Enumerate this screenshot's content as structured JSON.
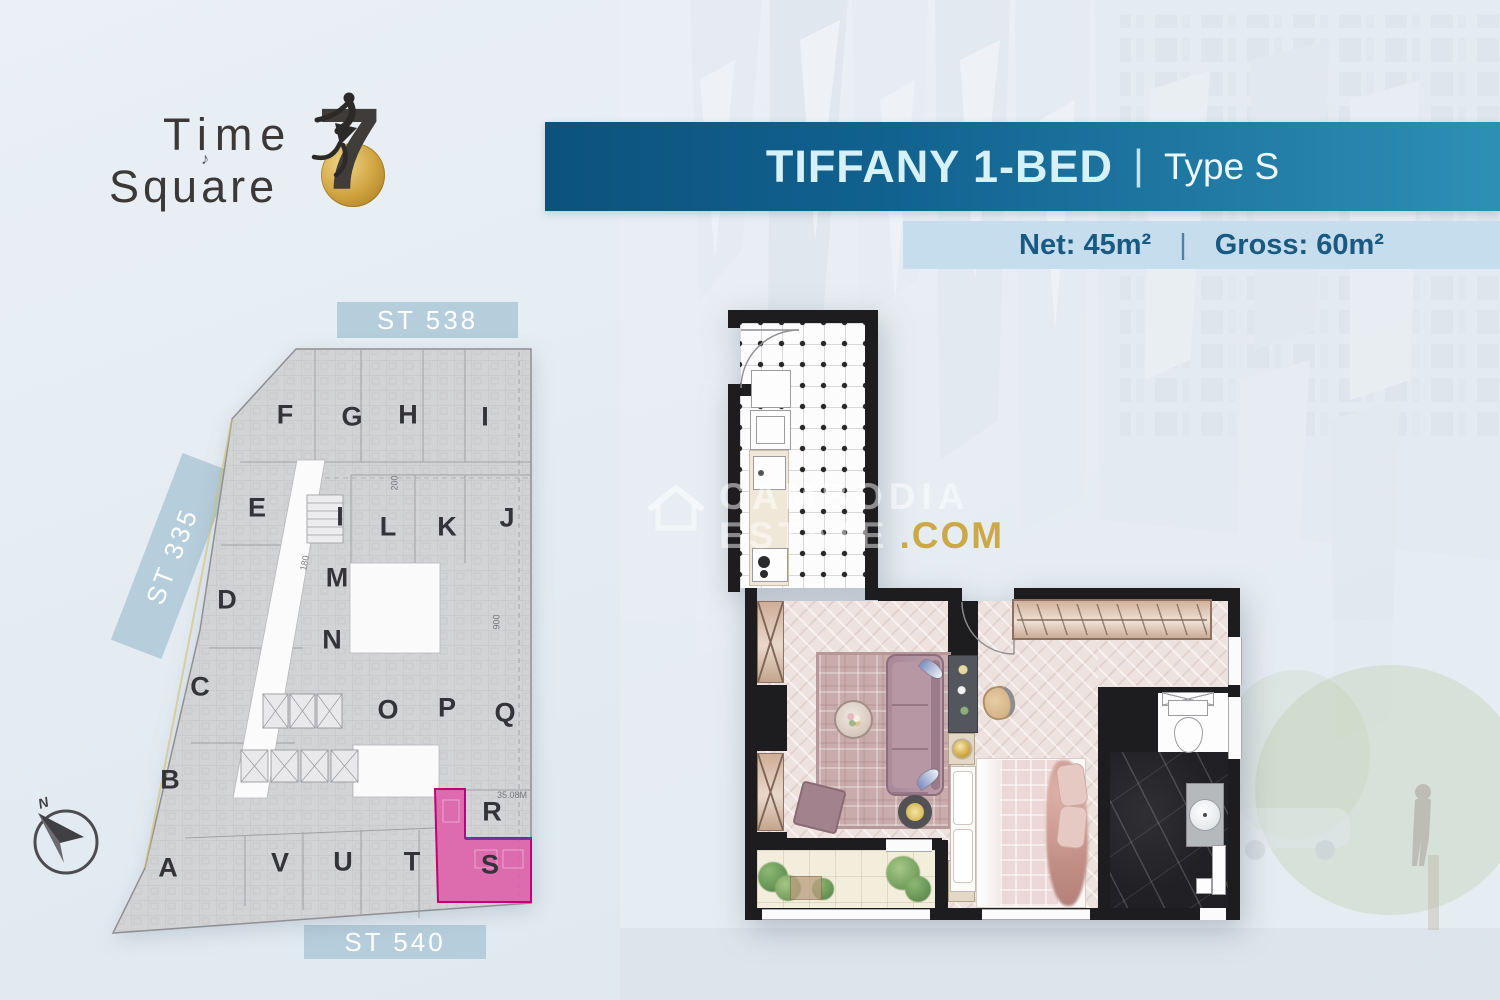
{
  "logo": {
    "line1": "Time",
    "line2": "Square",
    "numeral": "7",
    "note": "♪"
  },
  "title_banner": {
    "title": "TIFFANY 1-BED",
    "divider": "|",
    "type": "Type S"
  },
  "spec_banner": {
    "net": "Net: 45m²",
    "divider": "|",
    "gross": "Gross: 60m²"
  },
  "watermark": {
    "line1": "CAMBODIA",
    "line2": "ESTATE",
    "suffix": ".COM"
  },
  "site_plan": {
    "streets": {
      "top": "ST 538",
      "left": "ST 335",
      "bottom": "ST 540"
    },
    "compass_label": "N",
    "highlighted_unit": "S",
    "units": [
      {
        "label": "F",
        "x": 285,
        "y": 415
      },
      {
        "label": "G",
        "x": 352,
        "y": 417
      },
      {
        "label": "H",
        "x": 408,
        "y": 415
      },
      {
        "label": "I",
        "x": 485,
        "y": 417
      },
      {
        "label": "E",
        "x": 257,
        "y": 508
      },
      {
        "label": "I",
        "x": 340,
        "y": 517
      },
      {
        "label": "L",
        "x": 388,
        "y": 527
      },
      {
        "label": "K",
        "x": 447,
        "y": 527
      },
      {
        "label": "J",
        "x": 507,
        "y": 518
      },
      {
        "label": "M",
        "x": 337,
        "y": 578
      },
      {
        "label": "D",
        "x": 227,
        "y": 600
      },
      {
        "label": "N",
        "x": 332,
        "y": 640
      },
      {
        "label": "C",
        "x": 200,
        "y": 687
      },
      {
        "label": "O",
        "x": 388,
        "y": 710
      },
      {
        "label": "P",
        "x": 447,
        "y": 708
      },
      {
        "label": "Q",
        "x": 505,
        "y": 713
      },
      {
        "label": "B",
        "x": 170,
        "y": 780
      },
      {
        "label": "R",
        "x": 492,
        "y": 812
      },
      {
        "label": "A",
        "x": 168,
        "y": 868
      },
      {
        "label": "V",
        "x": 280,
        "y": 863
      },
      {
        "label": "U",
        "x": 343,
        "y": 862
      },
      {
        "label": "T",
        "x": 412,
        "y": 862
      },
      {
        "label": "S",
        "x": 490,
        "y": 865
      }
    ],
    "dimensions": [
      {
        "text": "200",
        "x": 387,
        "y": 478,
        "rot": -90
      },
      {
        "text": "180",
        "x": 297,
        "y": 558,
        "rot": -78
      },
      {
        "text": "900",
        "x": 489,
        "y": 617,
        "rot": -90
      },
      {
        "text": "35.08M",
        "x": 497,
        "y": 790,
        "rot": 0
      }
    ]
  },
  "colors": {
    "banner_dark": "#0c527e",
    "banner_light": "#2e8fb5",
    "title_text": "#d7f1f8",
    "spec_bg": "#c5dded",
    "spec_text": "#1a5a80",
    "street_bg": "#b6cddb",
    "highlight_pink": "#de5da8",
    "highlight_border": "#c20077",
    "watermark_gold": "#cba23a",
    "coin_gold": "#cfa23f"
  }
}
